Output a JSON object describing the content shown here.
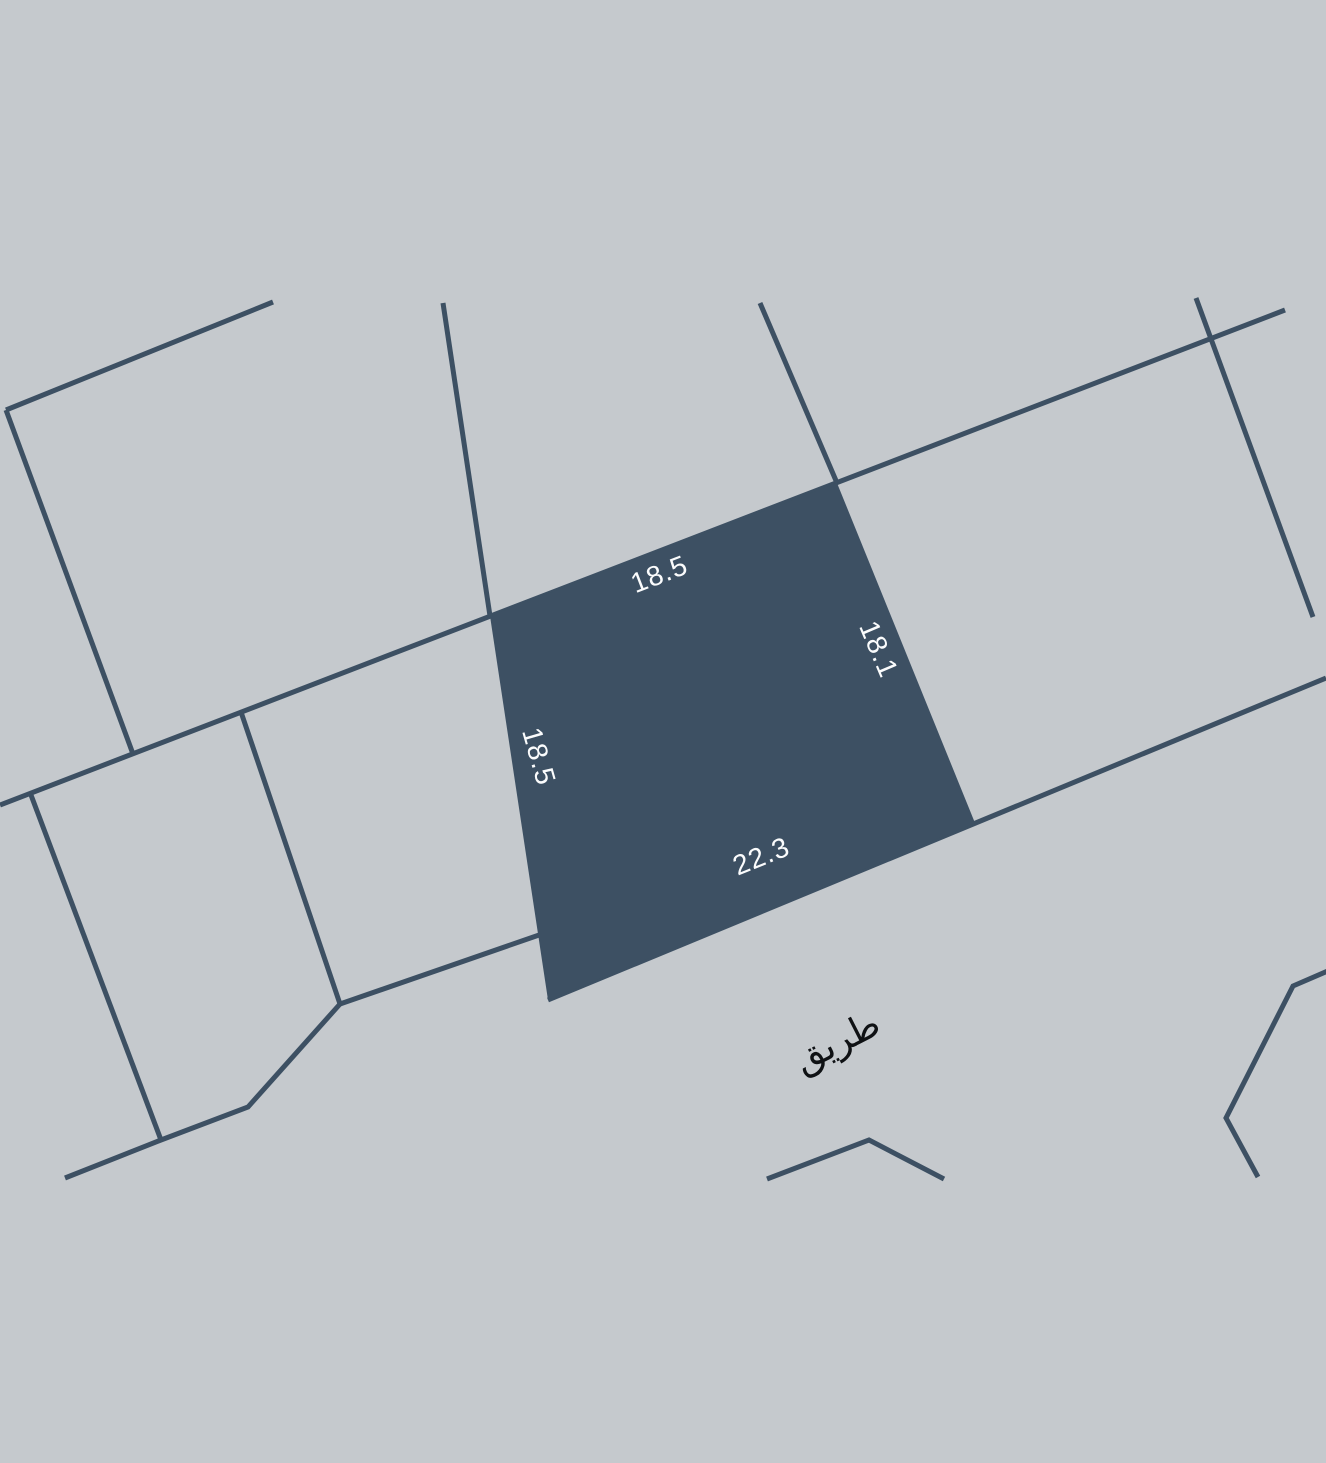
{
  "map": {
    "background_color": "#c5c9cd",
    "line_color": "#3d5063",
    "parcel": {
      "fill_color": "#3d5063",
      "label_color": "#fbfcfd",
      "dimensions": {
        "top": "18.5",
        "right": "18.1",
        "left": "18.5",
        "bottom": "22.3"
      }
    },
    "road_label": {
      "text": "طريق",
      "color": "#0f1114"
    }
  }
}
